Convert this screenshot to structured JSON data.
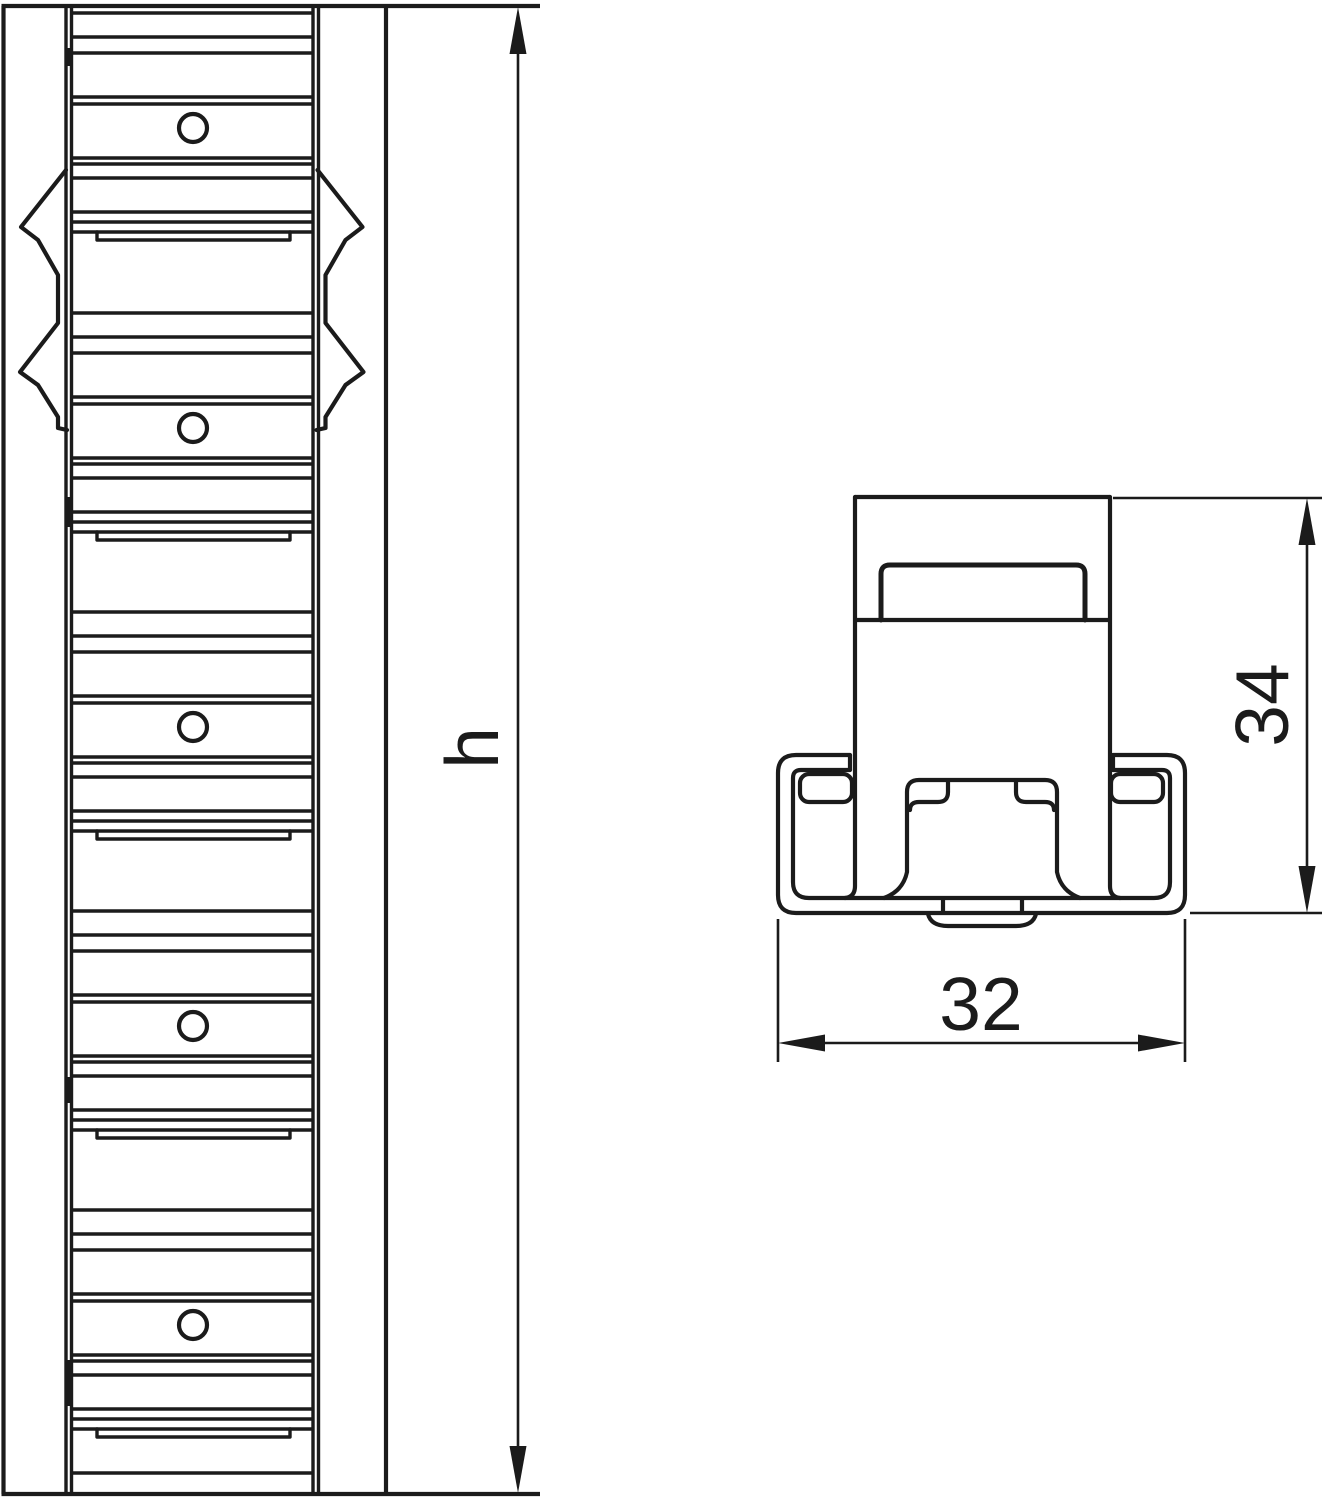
{
  "drawing": {
    "type": "technical-drawing",
    "background_color": "#ffffff",
    "line_color": "#1b1b1b",
    "front_view": {
      "name": "mounting-rail-front-view",
      "hole_count": 5,
      "slot_count": 5,
      "snap_tab_pairs": 2,
      "height_dimension_label": "h"
    },
    "section_view": {
      "name": "rail-cross-section",
      "height_dimension_label": "34",
      "width_dimension_label": "32"
    }
  }
}
